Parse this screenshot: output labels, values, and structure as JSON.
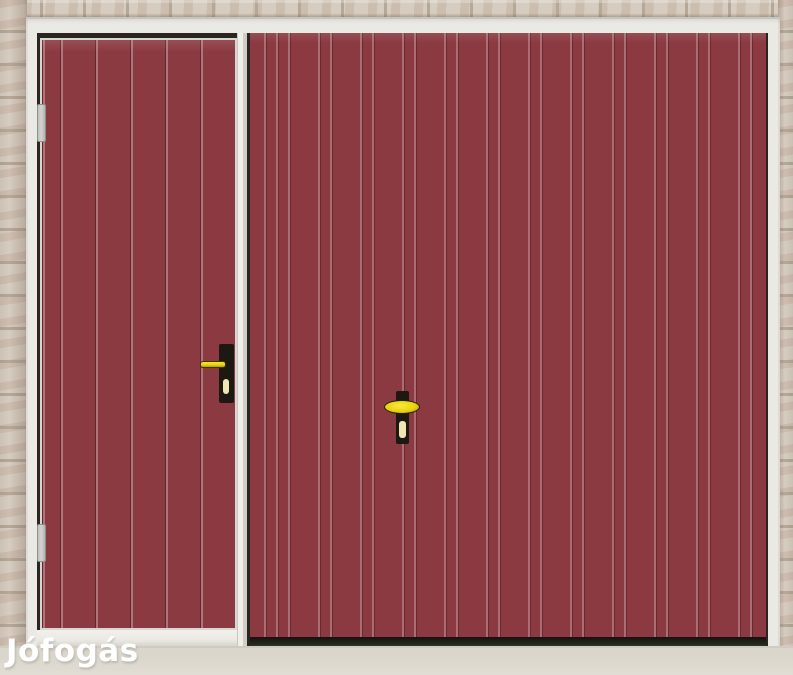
{
  "watermark": {
    "label": "Jófogás"
  },
  "colors": {
    "door_red": "#8B3A42",
    "frame_white": "#EBE9E4",
    "frame_edge": "#C6C4BF",
    "brick_base": "#D6CCBF",
    "brick_mortar": "#B5A897",
    "opening_dark": "#2B2420",
    "seal_dark": "#22261E",
    "floor_light": "#E1DDD4",
    "hinge_gray": "#D3D3D1",
    "handle_black": "#1D1812",
    "handle_yellow": "#E9D30F",
    "keyhole_pale": "#F0E6B4",
    "watermark_white": "#FFFFFF"
  }
}
